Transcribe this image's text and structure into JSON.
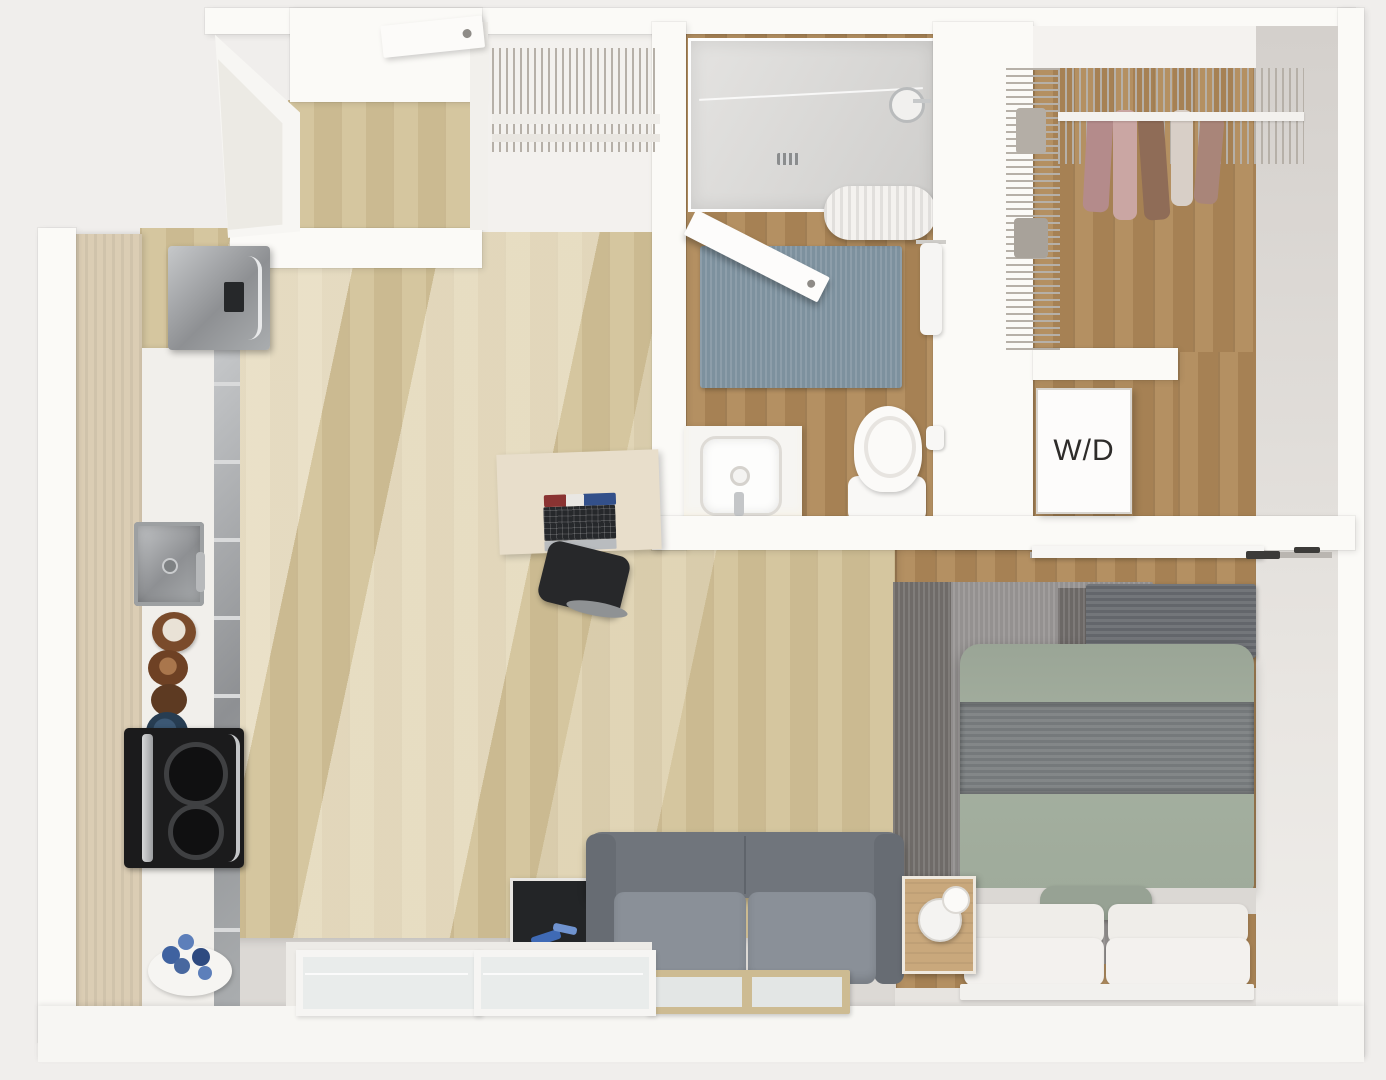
{
  "scene": {
    "type": "3D top-down apartment floor plan rendering",
    "style": "studio apartment with wood floors and white walls"
  },
  "labels": {
    "washer_dryer": "W/D"
  },
  "rooms": [
    "entry",
    "kitchen",
    "living area",
    "bathroom",
    "coat closet",
    "walk-in closet",
    "washer-dryer closet",
    "sleeping nook"
  ],
  "furniture": [
    "refrigerator",
    "tall kitchen cabinet",
    "kitchen counter",
    "kitchen sink",
    "cooktop with oven",
    "bowls",
    "vase with blue flowers",
    "upper cabinet shelf",
    "entry window panel",
    "entry door",
    "wire coat-closet shelf",
    "shower",
    "shower head",
    "rolled shower curtain",
    "bathroom door",
    "blue bath rug",
    "towel",
    "vanity with sink",
    "toilet",
    "toilet paper roll",
    "washer-dryer unit",
    "wire closet shelving",
    "hanging clothes",
    "sliding door and track",
    "desk",
    "laptop",
    "notebook",
    "desk chair",
    "gray sofa",
    "side table with framed art",
    "coffee table",
    "nightstand",
    "table lamp",
    "gray area rug",
    "dark throw bench",
    "bed with green duvet",
    "gray knit throw",
    "white pillows",
    "green accent pillow",
    "low windows along bottom wall"
  ],
  "colors": {
    "background": "#f0eeec",
    "wall": "#fbfaf7",
    "floor_light_wood": "#d2c298",
    "floor_dark_wood": "#b08a5a",
    "bath_rug_blue": "#7d919e",
    "area_rug_gray": "#949190",
    "sofa_gray": "#80868e",
    "bed_duvet_green": "#a2ad9d",
    "throw_gray": "#75797b",
    "appliance_steel": "#a6a8aa",
    "cooktop_black": "#1b1b1c",
    "wd_text": "#2e2c2a"
  }
}
